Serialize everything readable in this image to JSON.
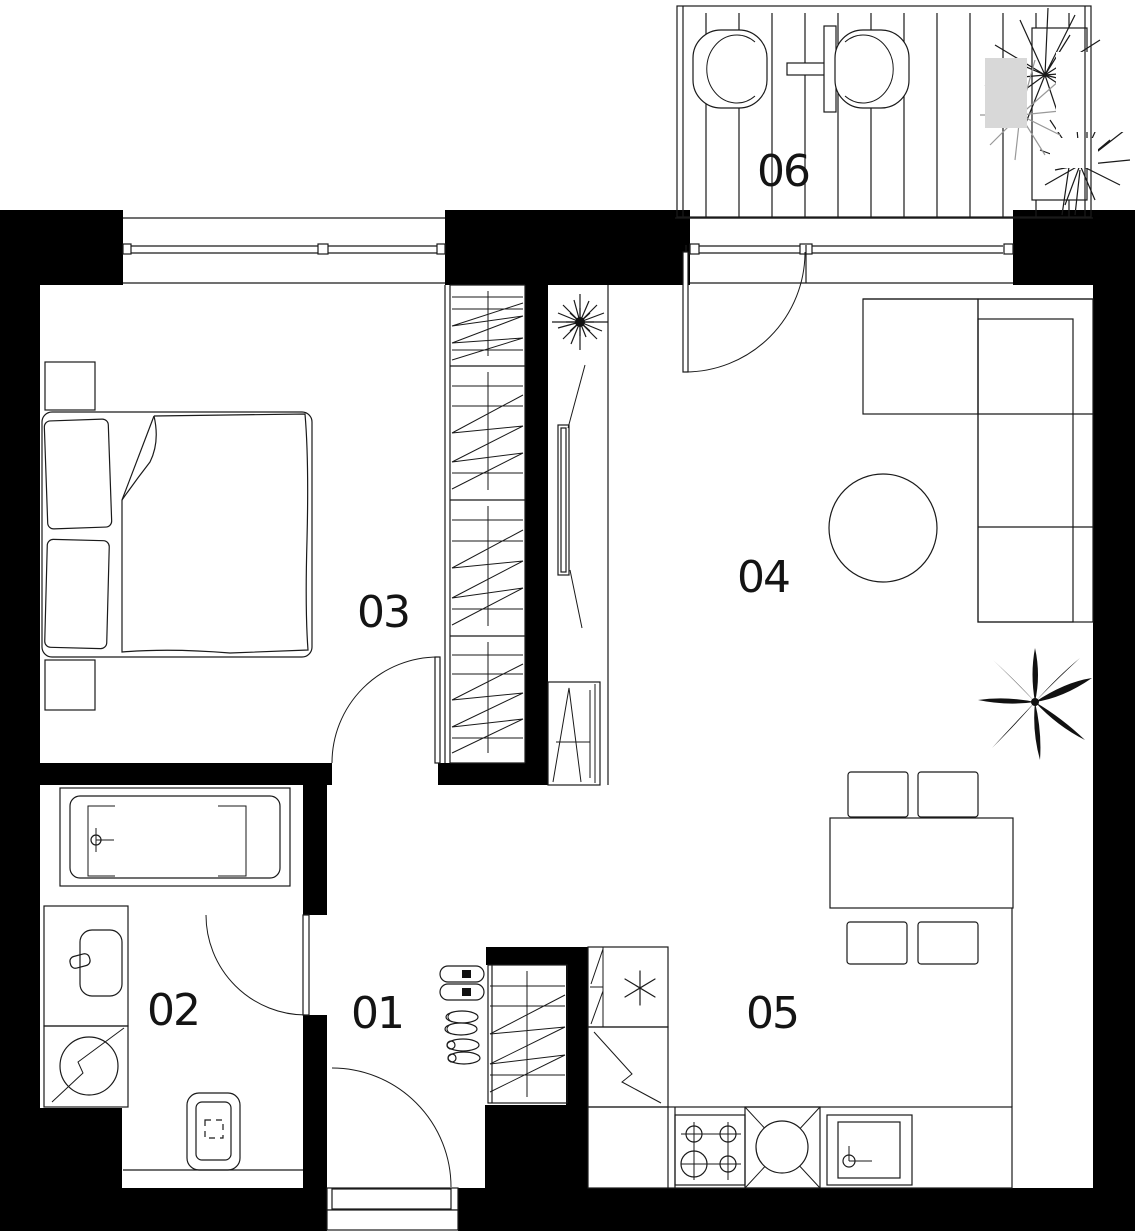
{
  "plan": {
    "background": "#ffffff",
    "wall_color": "#000000",
    "line_color": "#1a1a1a",
    "label_color": "#141414"
  },
  "rooms": [
    {
      "number": "01",
      "name": "hallway"
    },
    {
      "number": "02",
      "name": "bathroom"
    },
    {
      "number": "03",
      "name": "bedroom"
    },
    {
      "number": "04",
      "name": "living-room"
    },
    {
      "number": "05",
      "name": "kitchen"
    },
    {
      "number": "06",
      "name": "balcony"
    }
  ]
}
